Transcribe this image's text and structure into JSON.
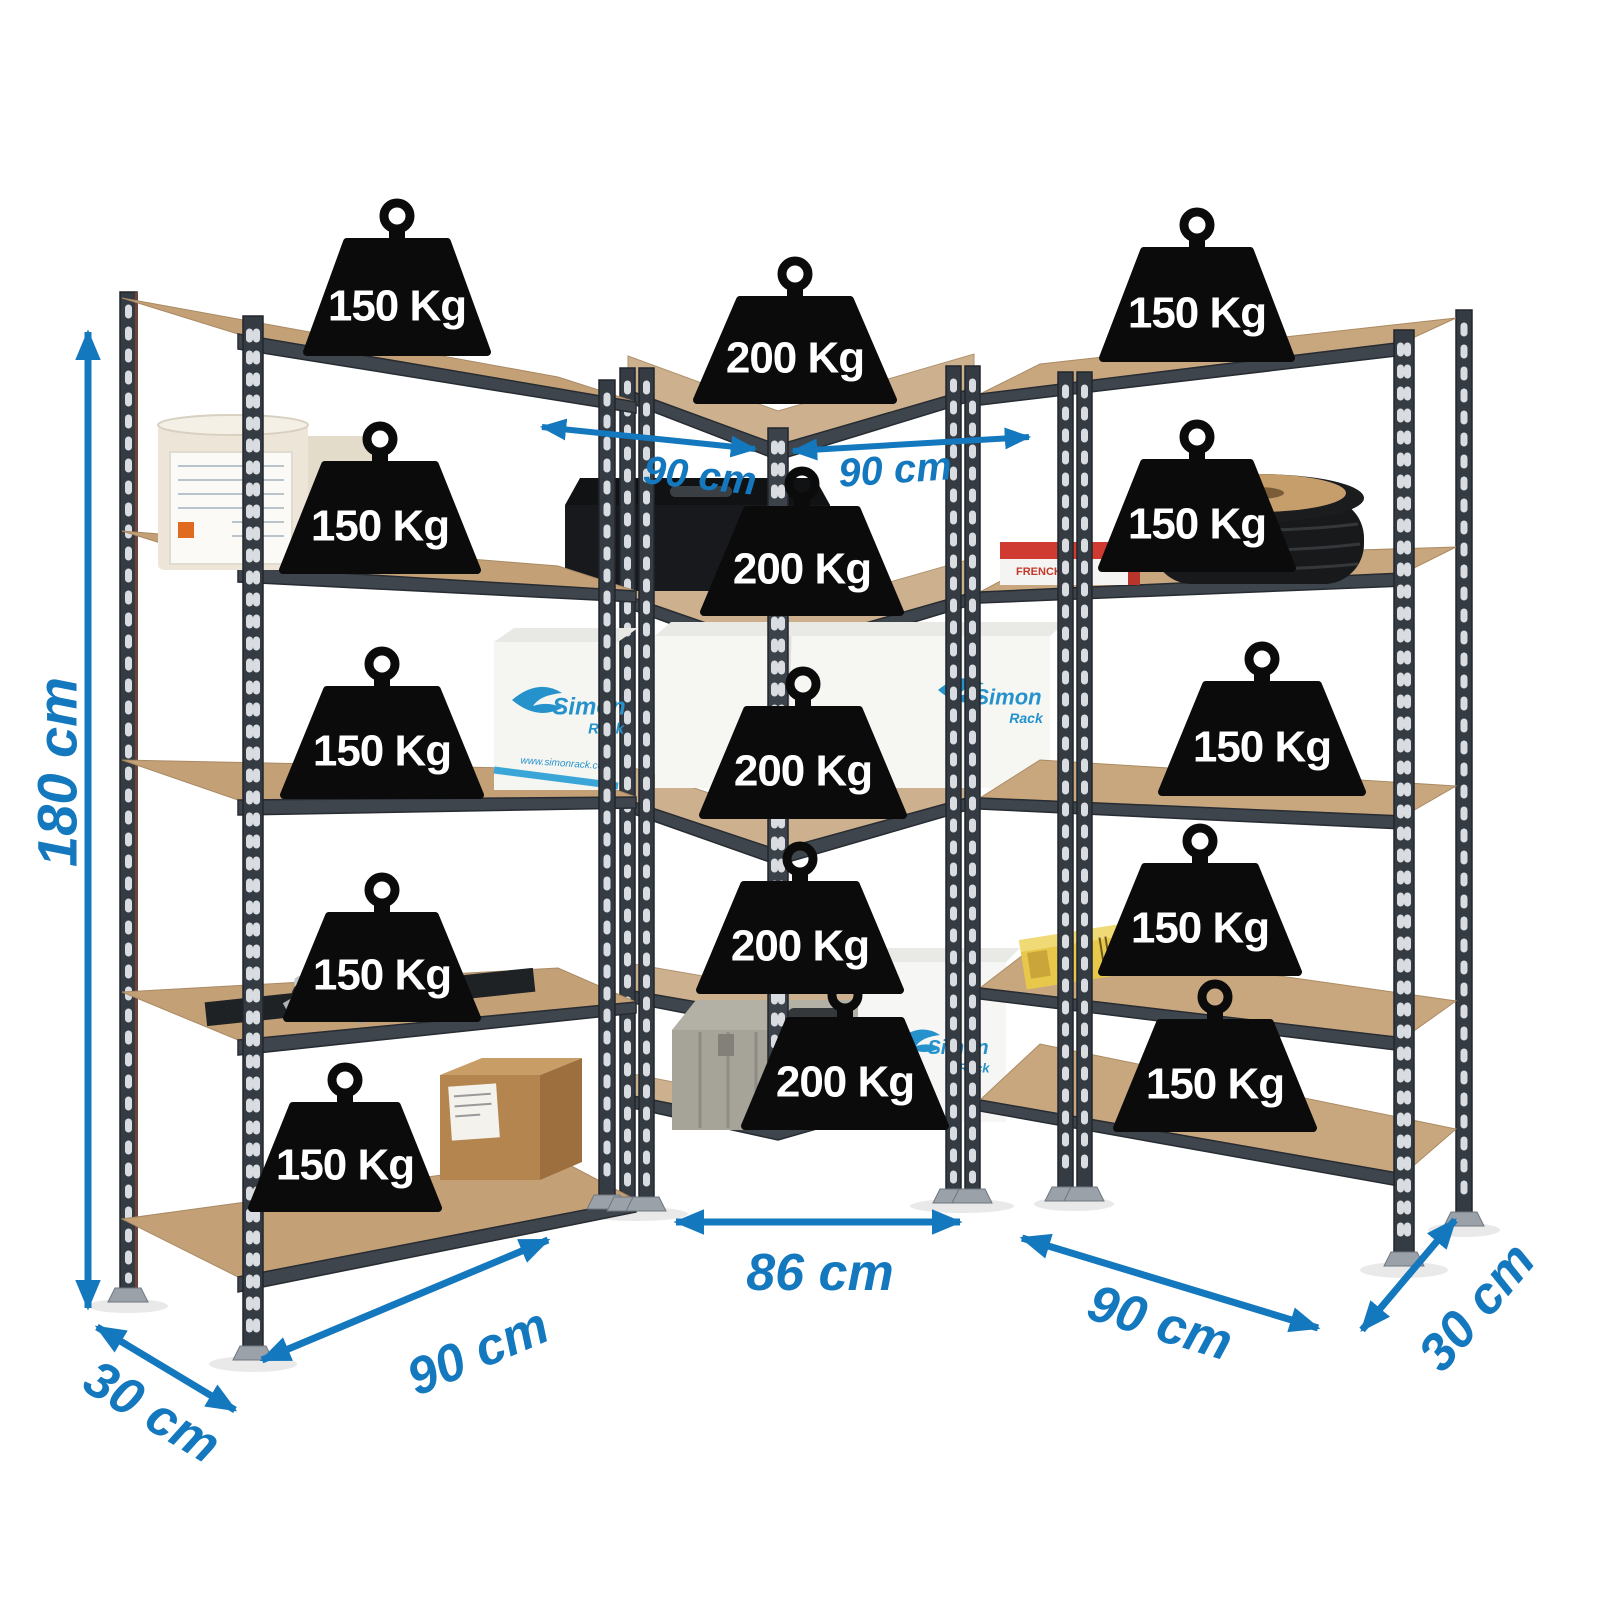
{
  "colors": {
    "background": "#ffffff",
    "dimension_blue": "#1478be",
    "weight_black": "#0b0b0c",
    "weight_text": "#ffffff",
    "frame_dark_grey": "#353b42",
    "shelf_wood": "#c7a37b",
    "brand_blue": "#2592cc"
  },
  "units": {
    "left": {
      "shelf_count": 5,
      "loads": [
        "150 Kg",
        "150 Kg",
        "150 Kg",
        "150 Kg",
        "150 Kg"
      ]
    },
    "middle": {
      "shelf_count": 5,
      "loads": [
        "200 Kg",
        "200 Kg",
        "200 Kg",
        "200 Kg",
        "200 Kg"
      ]
    },
    "right": {
      "shelf_count": 5,
      "loads": [
        "150 Kg",
        "150 Kg",
        "150 Kg",
        "150 Kg",
        "150 Kg"
      ]
    }
  },
  "dimensions": {
    "height": "180 cm",
    "top_span_left": "90 cm",
    "top_span_right": "90 cm",
    "bottom_width_left": "90 cm",
    "bottom_width_middle": "86 cm",
    "bottom_width_right": "90 cm",
    "depth_left": "30 cm",
    "depth_right": "30 cm"
  },
  "products": {
    "box_brand_line1": "Simon",
    "box_brand_line2": "Rack",
    "box_url": "www.simonrack.com",
    "red_box_label": "FRENCHI"
  }
}
